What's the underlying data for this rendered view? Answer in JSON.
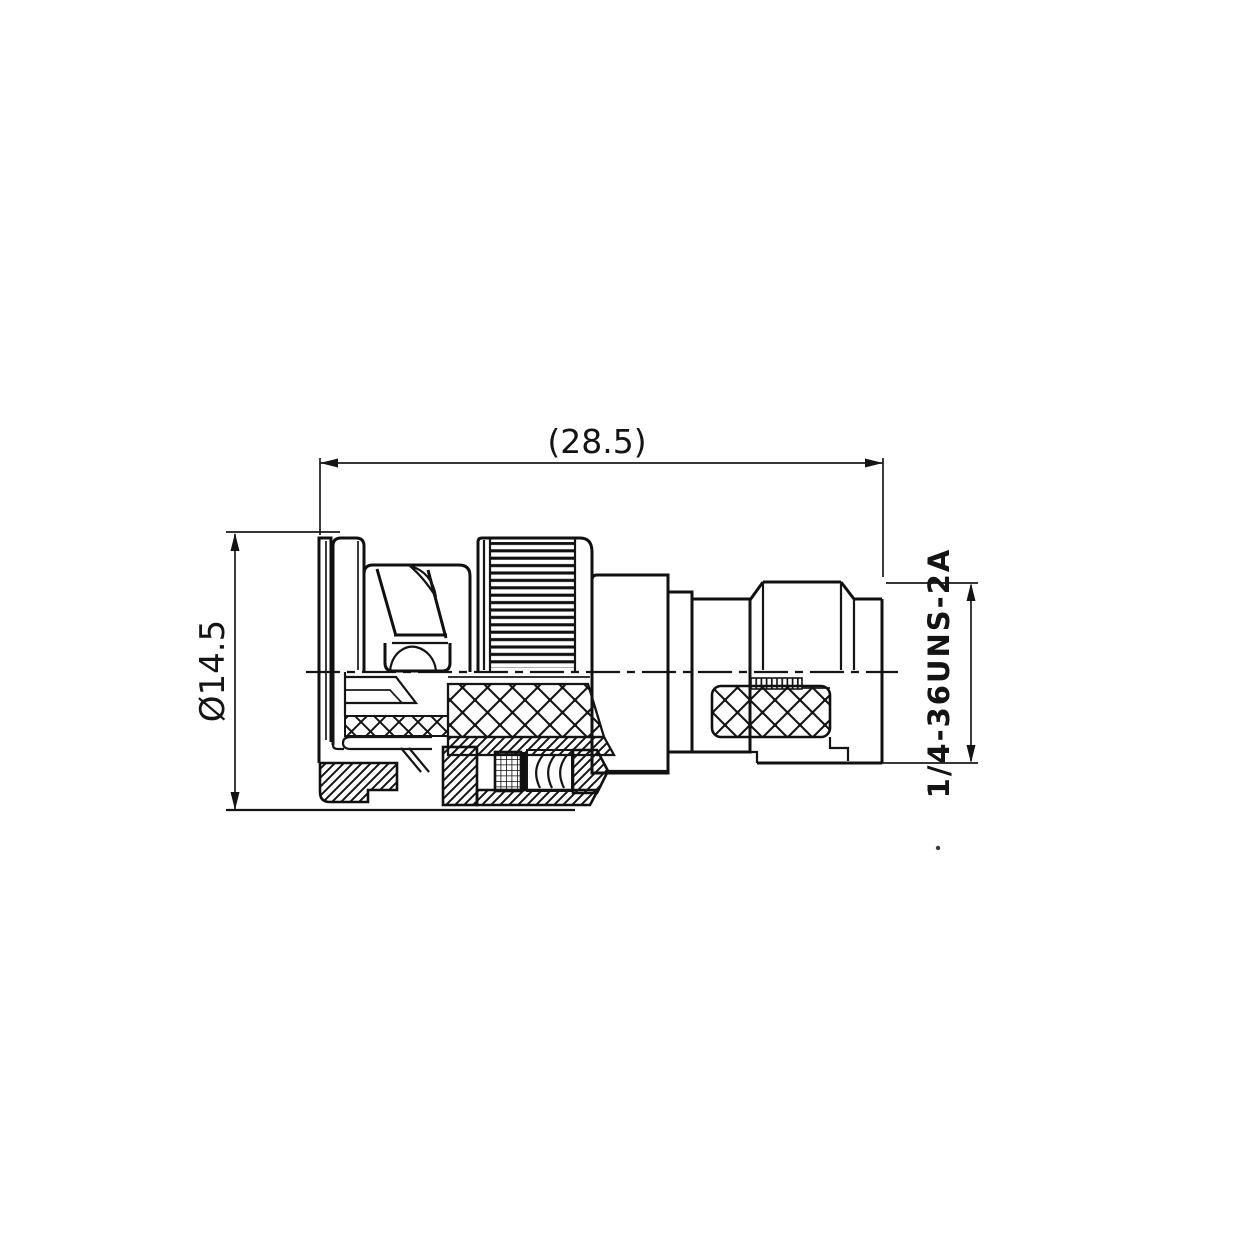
{
  "drawing": {
    "kind": "technical-drawing",
    "labels": {
      "length_dim": "(28.5)",
      "diameter_dim": "Ø14.5",
      "thread_spec": "1/4-36UNS-2A"
    },
    "colors": {
      "line": "#141414",
      "background": "#ffffff"
    }
  }
}
